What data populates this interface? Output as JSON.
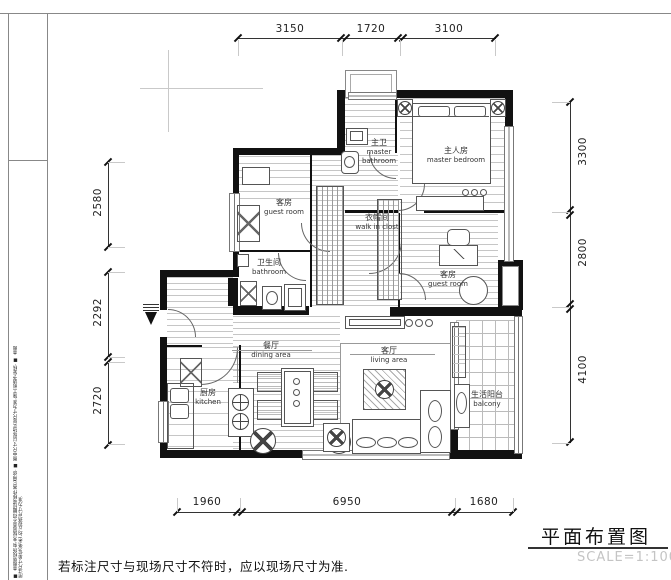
{
  "drawing": {
    "title": "平面布置图",
    "scale": "SCALE=1:100",
    "footer_note": "若标注尺寸与现场尺寸不符时，应以现场尺寸为准.",
    "side_notes": "■ 本图版权所有,未经同意不得翻印或移作其它用途. ■ 图中尺寸以现场实际尺寸为准,施工前请予复核. ■ 本图所注尺寸单位(毫米),均以现场尺寸为准."
  },
  "dimensions": {
    "top": [
      "3150",
      "1720",
      "3100"
    ],
    "left": [
      "2580",
      "2292",
      "2720"
    ],
    "right": [
      "3300",
      "2800",
      "4100"
    ],
    "bottom": [
      "1960",
      "6950",
      "1680"
    ]
  },
  "rooms": {
    "master_bathroom": {
      "zh": "主卫",
      "en": "master bathroom"
    },
    "master_bedroom": {
      "zh": "主人房",
      "en": "master bedroom"
    },
    "guest_room_top": {
      "zh": "客房",
      "en": "guest room"
    },
    "walk_in_closet": {
      "zh": "衣帽间",
      "en": "walk in clost"
    },
    "bathroom": {
      "zh": "卫生间",
      "en": "bathroom"
    },
    "guest_room_right": {
      "zh": "客房",
      "en": "guest room"
    },
    "dining": {
      "zh": "餐厅",
      "en": "dining area"
    },
    "living": {
      "zh": "客厅",
      "en": "living area"
    },
    "kitchen": {
      "zh": "厨房",
      "en": "kitchen"
    },
    "balcony": {
      "zh": "生活阳台",
      "en": "balcony"
    }
  }
}
